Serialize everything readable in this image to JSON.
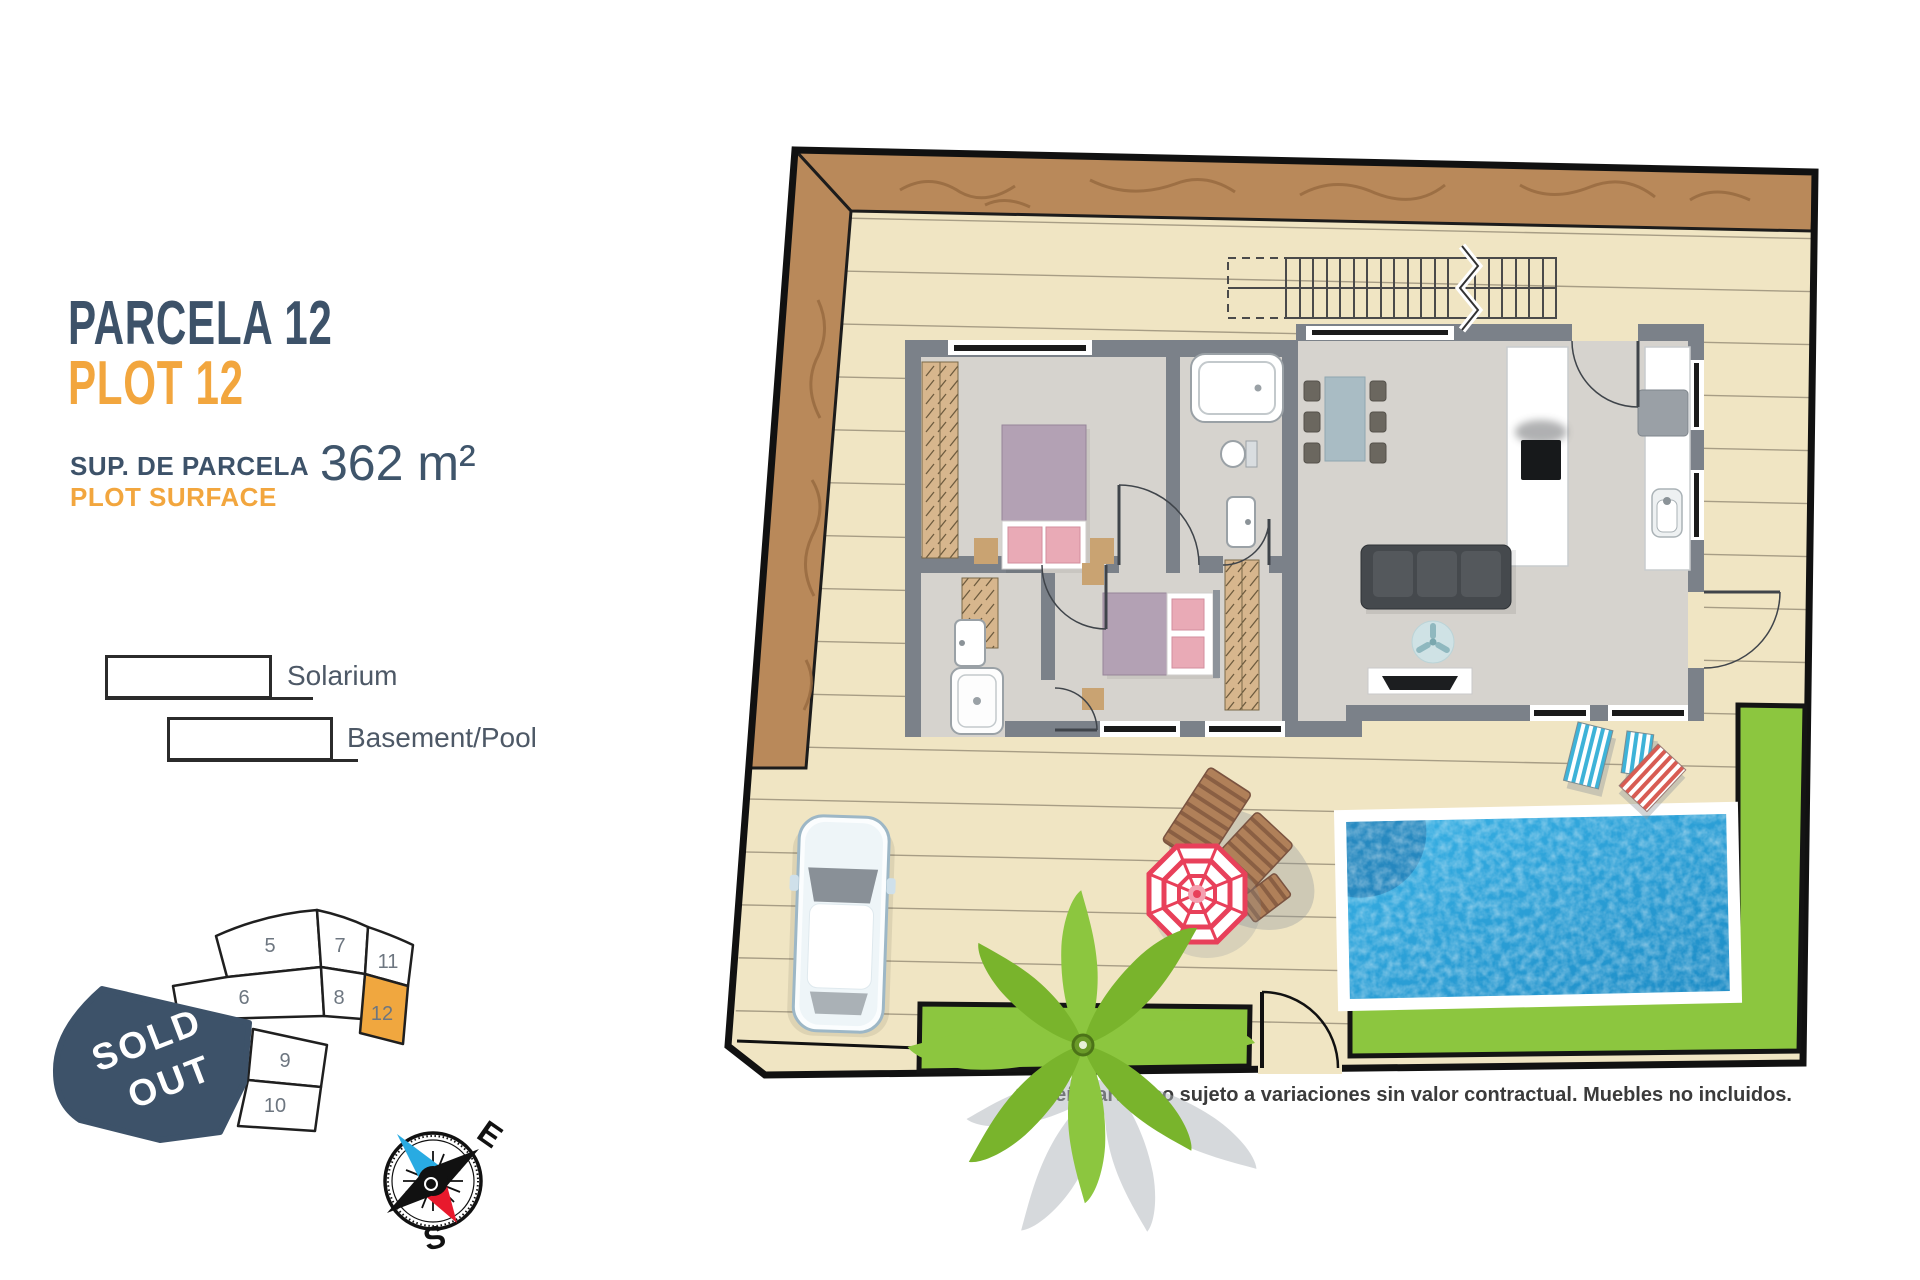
{
  "header": {
    "title_es": "PARCELA 12",
    "title_en": "PLOT 12",
    "surface_label_es": "SUP. DE PARCELA",
    "surface_label_en": "PLOT SURFACE",
    "surface_value": "362 m²"
  },
  "legend": {
    "items": [
      "Solarium",
      "Basement/Pool"
    ]
  },
  "minimap": {
    "plots": [
      "5",
      "6",
      "7",
      "8",
      "9",
      "10",
      "11",
      "12"
    ],
    "highlighted_plot": "12",
    "sold_out_lines": [
      "SOLD",
      "OUT"
    ]
  },
  "compass": {
    "east": "E",
    "south": "S"
  },
  "plan": {
    "disclaimer": "*Diseño artístico sujeto a variaciones sin valor contractual. Muebles no incluidos."
  },
  "colors": {
    "navy": "#3D5269",
    "orange": "#F2A63E",
    "deck": "#F0E5C3",
    "terrain": "#B9895A",
    "lawn": "#8CC63F",
    "pool": "#2BA7E0",
    "wall": "#7B8189",
    "sold_out_fill": "#3D5269",
    "plot_highlight": "#F0A73F"
  }
}
